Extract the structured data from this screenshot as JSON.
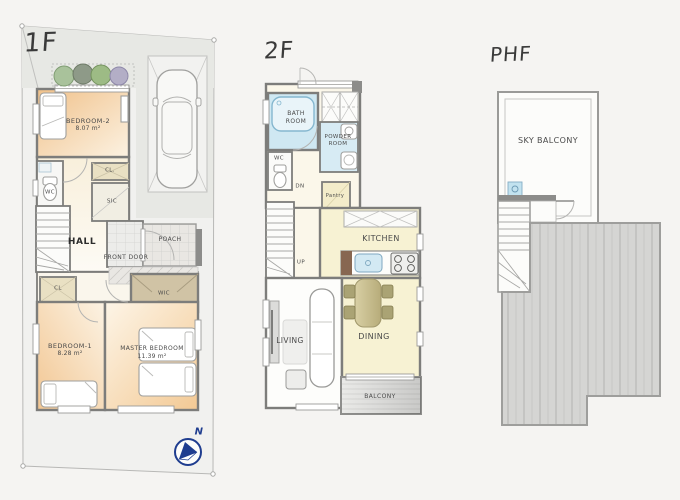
{
  "page": {
    "background": "#f5f4f2"
  },
  "f1": {
    "title": "1F",
    "bedroom2": "BEDROOM-2",
    "bedroom2_area": "8.07 m²",
    "wc": "WC",
    "closet_upper": "CL.",
    "sic": "SIC",
    "hall": "HALL",
    "front_door": "FRONT DOOR",
    "porch": "POACH",
    "closet_lower": "CL",
    "bedroom1": "BEDROOM-1",
    "bedroom1_area": "8.28 m²",
    "wic": "WIC",
    "master_bedroom": "MASTER BEDROOM",
    "master_bedroom_area": "11.39 m²",
    "compass_north": "N"
  },
  "f2": {
    "title": "2F",
    "bath_line1": "BATH",
    "bath_line2": "ROOM",
    "powder_line1": "POWDER",
    "powder_line2": "ROOM",
    "wc": "WC",
    "stairs_down": "DN",
    "pantry": "Pantry",
    "stairs_up": "UP",
    "kitchen": "KITCHEN",
    "living": "LIVING",
    "dining": "DINING",
    "balcony": "BALCONY"
  },
  "phf": {
    "title": "PHF",
    "sky_balcony": "SKY BALCONY"
  },
  "colors": {
    "wall": "#7d7d7b",
    "bedroom_orange": "#f2c694",
    "lounge_yellow": "#f7f2d3",
    "bath_blue": "#cfe8f2",
    "closet_tan": "#e9e0c3",
    "wic_tan": "#d0c3a5",
    "roof_gray": "#d5d5d3",
    "compass_navy": "#1f3d8f"
  }
}
